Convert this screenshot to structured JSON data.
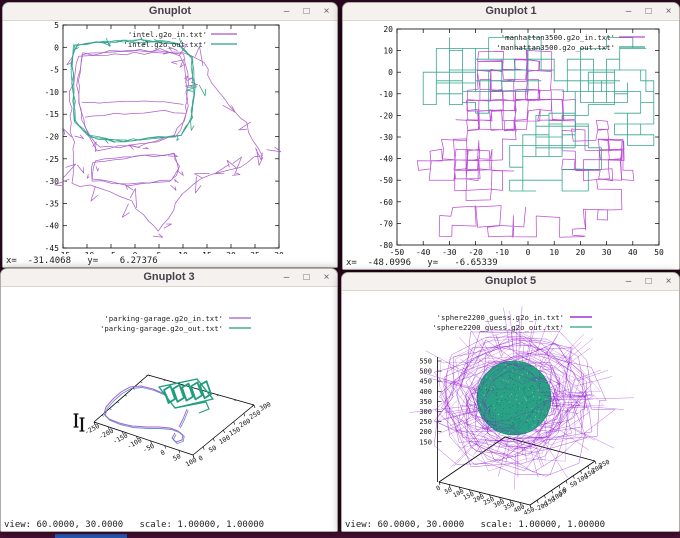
{
  "desktop": {
    "background": "#2d0a22",
    "top_strip_color": "#1c0517",
    "bottom_strip_color": "#4a1136",
    "taskbar_accent_color": "#2e62c8"
  },
  "window_controls": {
    "minimize": "–",
    "maximize": "□",
    "close": "×"
  },
  "windows": [
    {
      "title": "Gnuplot",
      "status": {
        "text": "x=  -31.4068   y=    6.27376",
        "x": "-31.4068",
        "y": "6.27376"
      }
    },
    {
      "title": "Gnuplot 1",
      "status": {
        "text": "x=  -48.0996   y=   -6.65339",
        "x": "-48.0996",
        "y": "-6.65339"
      }
    },
    {
      "title": "Gnuplot 3",
      "status": {
        "text": "view: 60.0000, 30.0000   scale: 1.00000, 1.00000",
        "view": "60.0000, 30.0000",
        "scale": "1.00000, 1.00000"
      }
    },
    {
      "title": "Gnuplot 5",
      "status": {
        "text": "view: 60.0000, 30.0000   scale: 1.00000, 1.00000",
        "view": "60.0000, 30.0000",
        "scale": "1.00000, 1.00000"
      }
    }
  ],
  "chart_data": [
    {
      "type": "line",
      "window": "Gnuplot",
      "series": [
        {
          "name": "'intel.g2o_in.txt'",
          "color": "#a958c8"
        },
        {
          "name": "'intel.g2o_out.txt'",
          "color": "#2aa188"
        }
      ],
      "xlim": [
        -15,
        30
      ],
      "ylim": [
        -45,
        5
      ],
      "xticks": [
        -15,
        -10,
        -5,
        0,
        5,
        10,
        15,
        20,
        25,
        30
      ],
      "yticks": [
        5,
        0,
        -5,
        -10,
        -15,
        -20,
        -25,
        -30,
        -35,
        -40,
        -45
      ],
      "legend_position": "top-right",
      "grid": false,
      "description": "2D SLAM pose-graph: raw input trajectory (purple) spans roughly x -14..27, y -42..2 with spiky scan rays and a lower room loop; optimized output (teal) forms a rounded rectangular loop near x -13..12, y -22..1"
    },
    {
      "type": "line",
      "window": "Gnuplot 1",
      "series": [
        {
          "name": "'manhattan3500.g2o_in.txt'",
          "color": "#b946d2"
        },
        {
          "name": "'manhattan3500.g2o_out.txt'",
          "color": "#2aa188"
        }
      ],
      "xlim": [
        -50,
        50
      ],
      "ylim": [
        -80,
        20
      ],
      "xticks": [
        -50,
        -40,
        -30,
        -20,
        -10,
        0,
        10,
        20,
        30,
        40,
        50
      ],
      "yticks": [
        20,
        10,
        0,
        -10,
        -20,
        -30,
        -40,
        -50,
        -60,
        -70,
        -80
      ],
      "legend_position": "top-right",
      "grid": false,
      "description": "Manhattan-world grid pose graph: input walk (purple, slightly rotated squares) concentrated lower/center, optimized output (teal) axis-aligned grid blocks upper-left and middle-right"
    },
    {
      "type": "line3d",
      "window": "Gnuplot 3",
      "series": [
        {
          "name": "'parking-garage.g2o_in.txt'",
          "color": "#a35ad2"
        },
        {
          "name": "'parking-garage.g2o_out.txt'",
          "color": "#1f9e7d"
        }
      ],
      "xticks": [
        -250,
        -200,
        -150,
        -100,
        -50,
        0,
        50,
        100
      ],
      "yticks": [
        0,
        50,
        100,
        150,
        200,
        250,
        300
      ],
      "view": [
        60,
        30
      ],
      "scale": [
        1,
        1
      ],
      "legend_position": "top-center",
      "description": "3D parking-garage trajectory: teal coiled multi-level ramp structure at upper right of floor plane, purple (with blue companion) looping drive path sweeping left and hooking down to a small terminal loop"
    },
    {
      "type": "line3d",
      "window": "Gnuplot 5",
      "series": [
        {
          "name": "'sphere2200_guess.g2o_in.txt'",
          "color": "#8f0ad0"
        },
        {
          "name": "'sphere2200_guess.g2o_out.txt'",
          "color": "#2aa084"
        }
      ],
      "xticks": [
        0,
        50,
        100,
        150,
        200,
        250,
        300,
        350,
        400,
        450
      ],
      "yticks": [
        -200,
        -150,
        -100,
        -50,
        0,
        50,
        100,
        150,
        200,
        250
      ],
      "zticks": [
        550,
        500,
        450,
        400,
        350,
        300,
        250,
        200,
        150
      ],
      "view": [
        60,
        30
      ],
      "scale": [
        1,
        1
      ],
      "legend_position": "top-center",
      "description": "3D sphere dataset: dense spiky purple tangle (initial guess) surrounding the optimized teal sphere centered near z=350-400"
    }
  ]
}
